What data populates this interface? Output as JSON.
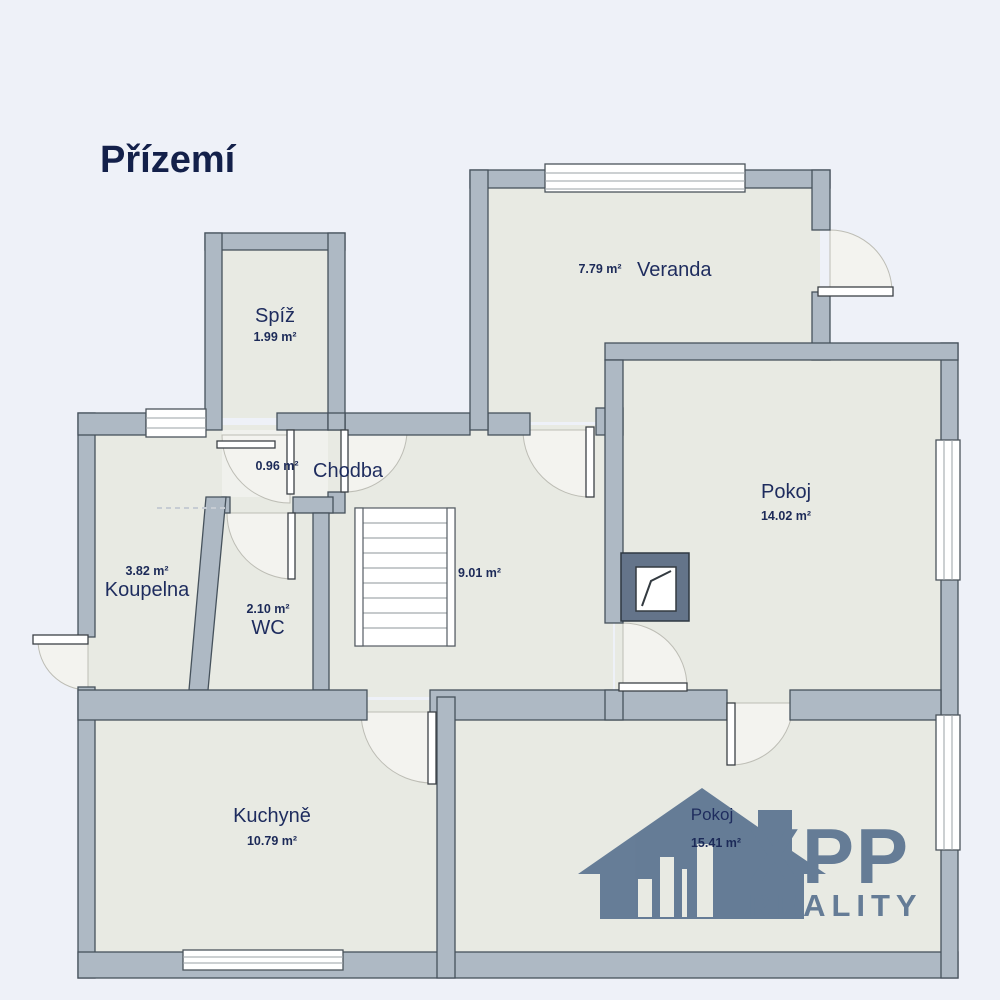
{
  "title": "Přízemí",
  "brand": {
    "name": "XPP",
    "subtitle": "REALITY"
  },
  "rooms": {
    "spiz": {
      "name": "Spíž",
      "area": "1.99 m²"
    },
    "veranda": {
      "name": "Veranda",
      "area": "7.79 m²"
    },
    "chodba": {
      "name": "Chodba",
      "area": "9.01 m²",
      "vestibule_area": "0.96 m²"
    },
    "pokoj1": {
      "name": "Pokoj",
      "area": "14.02 m²"
    },
    "koupelna": {
      "name": "Koupelna",
      "area": "3.82 m²"
    },
    "wc": {
      "name": "WC",
      "area": "2.10 m²"
    },
    "kuchyne": {
      "name": "Kuchyně",
      "area": "10.79 m²"
    },
    "pokoj2": {
      "name": "Pokoj",
      "area": "15.41 m²"
    }
  },
  "colors": {
    "background": "#eef1f8",
    "wall": "#aeb9c4",
    "wall_outline": "#46525c",
    "room_fill": "#e8eae3",
    "label_navy": "#1e2c5e",
    "brand_blue": "#5a7390",
    "chimney_dark": "#64748a"
  }
}
